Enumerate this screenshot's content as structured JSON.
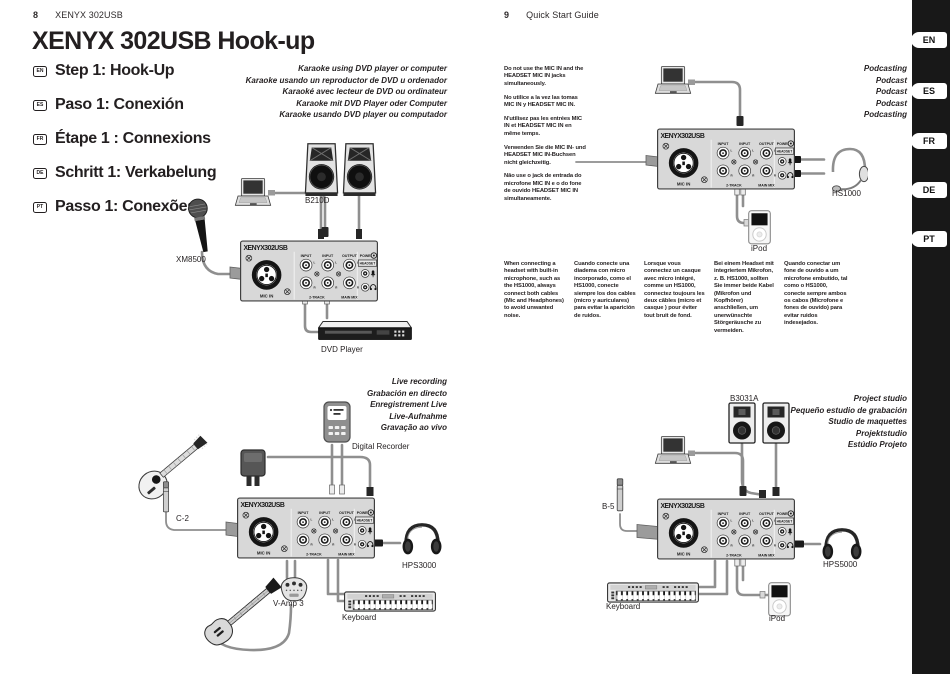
{
  "left_page": {
    "page_number": "8",
    "doc_title": "XENYX 302USB",
    "title": "XENYX 302USB Hook-up",
    "steps": [
      {
        "code": "EN",
        "label": "Step 1: Hook-Up"
      },
      {
        "code": "ES",
        "label": "Paso 1: Conexión"
      },
      {
        "code": "FR",
        "label": "Étape 1 : Connexions"
      },
      {
        "code": "DE",
        "label": "Schritt 1: Verkabelung"
      },
      {
        "code": "PT",
        "label": "Passo 1: Conexões"
      }
    ],
    "karaoke_captions": [
      "Karaoke using DVD player or computer",
      "Karaoke usando un reproductor de DVD u ordenador",
      "Karaoké avec lecteur de DVD ou ordinateur",
      "Karaoke mit DVD Player oder Computer",
      "Karaoke usando DVD player ou computador"
    ],
    "live_captions": [
      "Live recording",
      "Grabación en directo",
      "Enregistrement Live",
      "Live-Aufnahme",
      "Gravação ao vivo"
    ],
    "labels": {
      "mic": "XM8500",
      "speakers": "B210D",
      "dvd_player": "DVD Player",
      "condenser_mic": "C-2",
      "digital_recorder": "Digital Recorder",
      "headphones": "HPS3000",
      "vamp": "V-Amp 3",
      "keyboard": "Keyboard"
    }
  },
  "right_page": {
    "page_number": "9",
    "doc_title": "Quick Start Guide",
    "mic_notes": [
      "Do not use the MIC IN and the HEADSET MIC IN jacks simultaneously.",
      "No utilice a la vez las tomas MIC IN y HEADSET MIC IN.",
      "N'utilisez pas les entrées MIC IN et HEADSET MIC IN en même temps.",
      "Verwenden Sie die MIC IN- und HEADSET MIC IN-Buchsen nicht gleichzeitig.",
      "Não use o jack de entrada do microfone MIC IN e o do fone de ouvido HEADSET MIC IN simultaneamente."
    ],
    "podcast_captions": [
      "Podcasting",
      "Podcast",
      "Podcast",
      "Podcast",
      "Podcasting"
    ],
    "studio_captions": [
      "Project studio",
      "Pequeño estudio de grabación",
      "Studio de maquettes",
      "Projektstudio",
      "Estúdio Projeto"
    ],
    "headset_notes": [
      "When connecting a headset with built-in microphone, such as the HS1000, always connect both cables (Mic and Headphones) to avoid unwanted noise.",
      "Cuando conecte una diadema con micro incorporado, como el HS1000, conecte siempre los dos cables (micro y auriculares) para evitar la aparición de ruidos.",
      "Lorsque vous connectez un casque avec micro intégré, comme un HS1000, connectez toujours les deux câbles (micro et casque ) pour éviter tout bruit de fond.",
      "Bei einem Headset mit integriertem Mikrofon, z. B. HS1000, sollten Sie immer beide Kabel (Mikrofon und Kopfhörer) anschließen, um unerwünschte Störgeräusche zu vermeiden.",
      "Quando conectar um fone de ouvido a um microfone embutido, tal como o HS1000, conecte sempre ambos os cabos (Microfone e fones de ouvido) para evitar ruidos indesejados."
    ],
    "labels": {
      "headset": "HS1000",
      "ipod_top": "iPod",
      "monitors": "B3031A",
      "mic": "B-5",
      "headphones": "HPS5000",
      "keyboard": "Keyboard",
      "ipod_bottom": "iPod"
    }
  },
  "sidebar": {
    "tabs": [
      "EN",
      "ES",
      "FR",
      "DE",
      "PT"
    ]
  },
  "mixer": {
    "logo": "XENYX302USB",
    "labels": {
      "mic_in": "MIC IN",
      "input": "INPUT",
      "output": "OUTPUT",
      "power": "POWER",
      "headset": "HEADSET",
      "two_track": "2-TRACK",
      "main_mix": "MAIN MIX",
      "left": "L",
      "right": "R"
    }
  }
}
